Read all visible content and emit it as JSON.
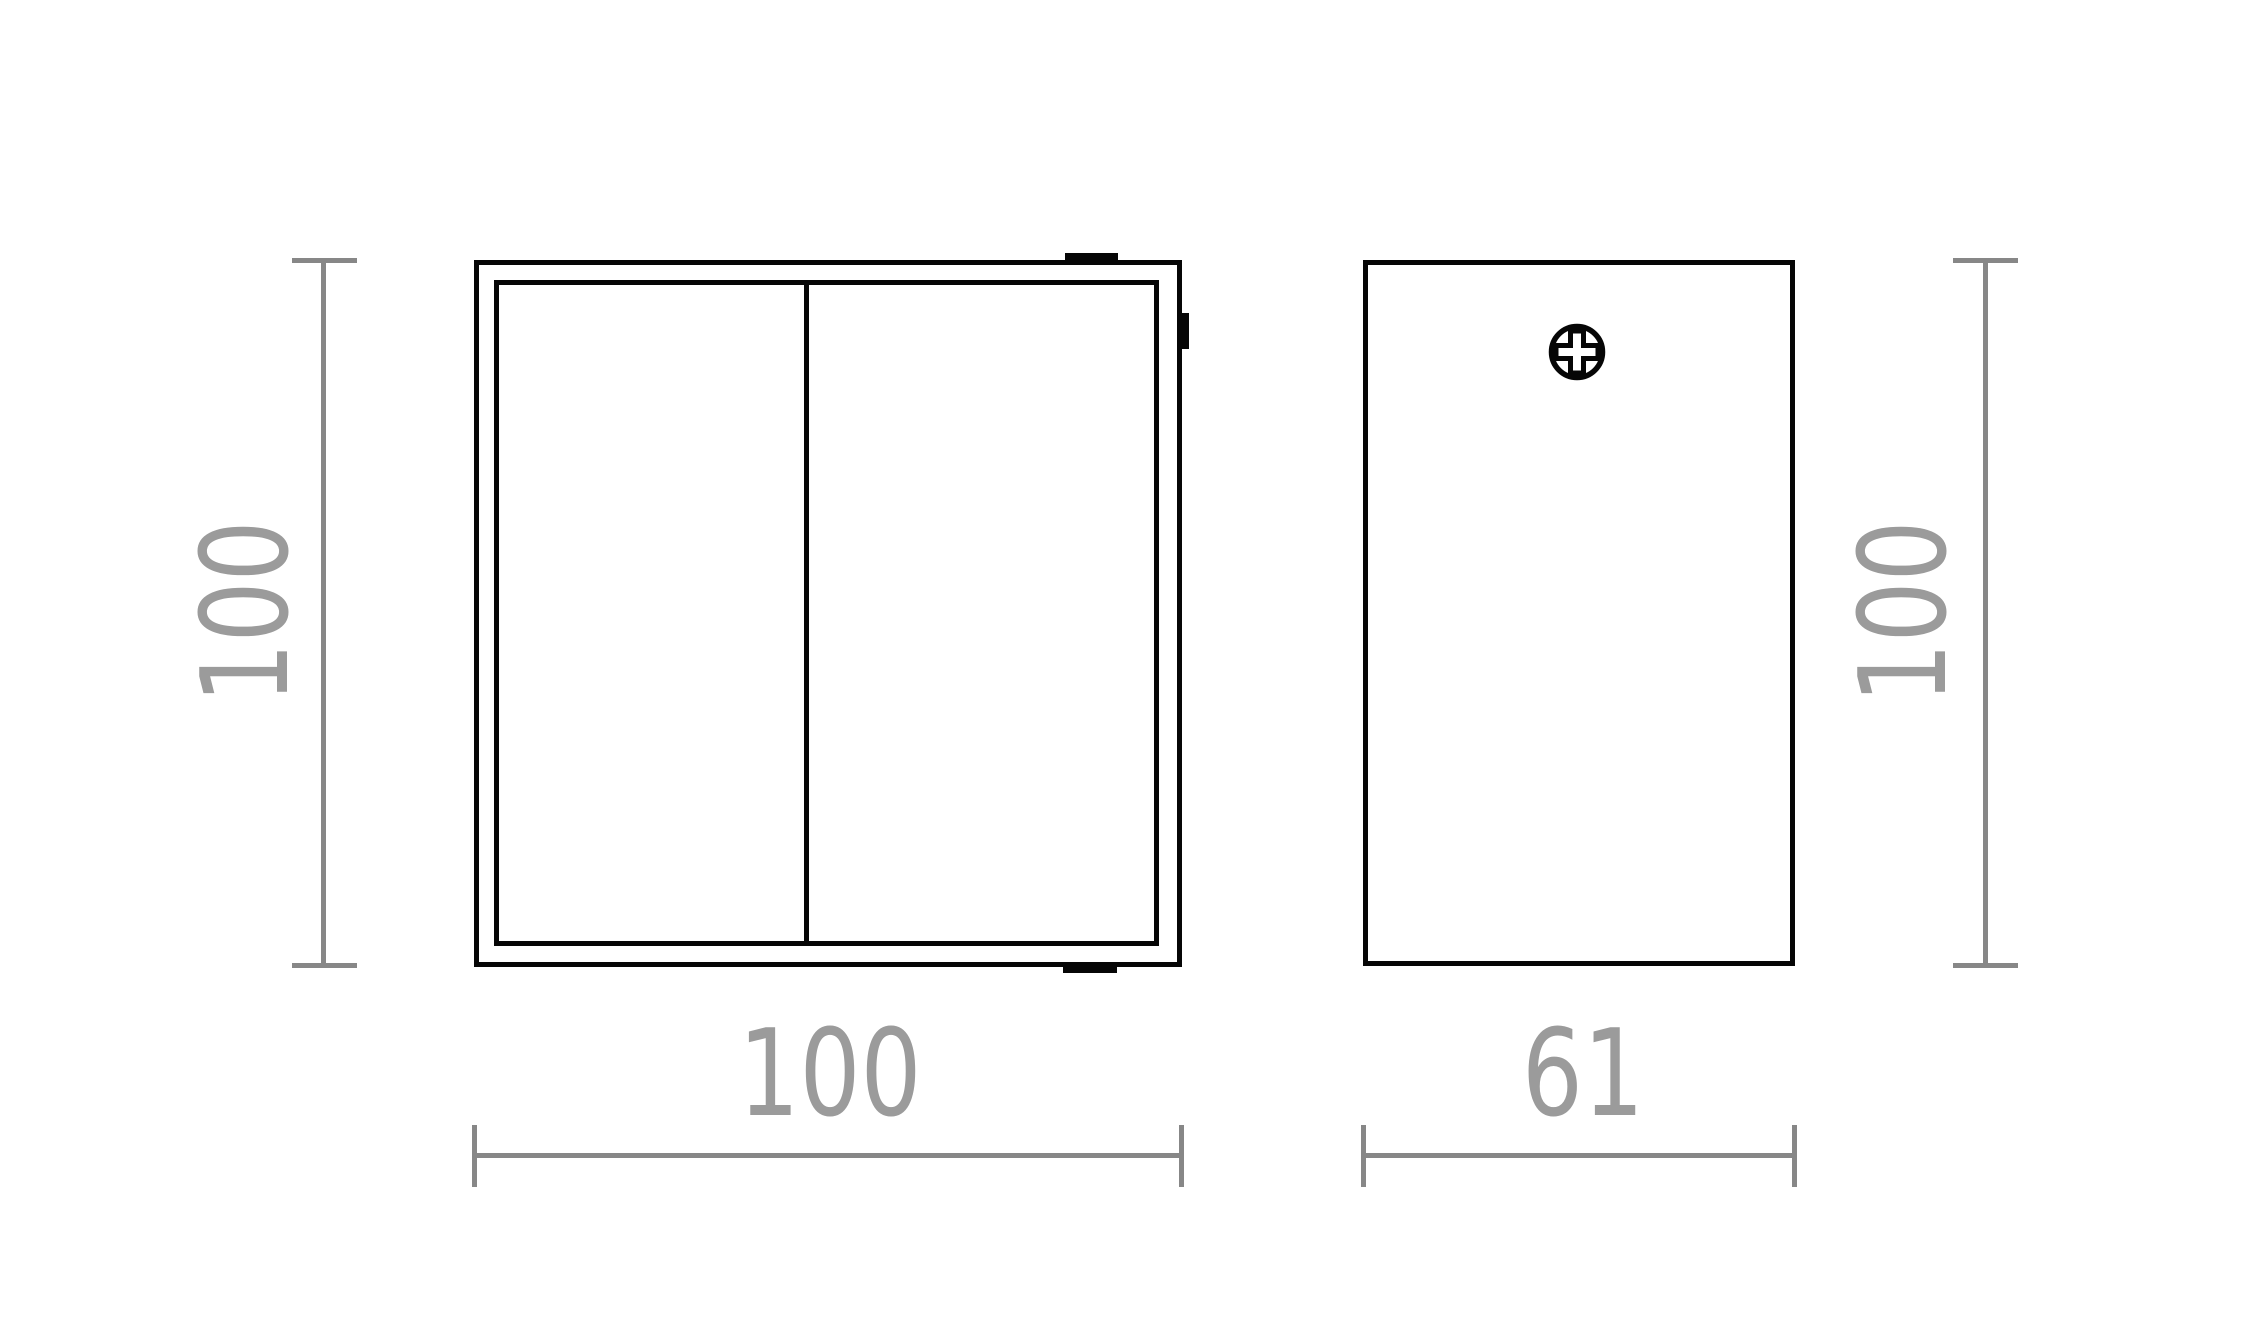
{
  "drawing": {
    "type": "technical-dimension-drawing",
    "colors": {
      "background": "#ffffff",
      "outline": "#060606",
      "dimension_line": "#878787",
      "dimension_text": "#9b9b9b"
    },
    "views": {
      "front": {
        "height_dimension": {
          "label": "100"
        },
        "width_dimension": {
          "label": "100"
        }
      },
      "side": {
        "width_dimension": {
          "label": "61"
        },
        "height_dimension": {
          "label": "100"
        }
      }
    },
    "icons": {
      "screw": "phillips-screw-head-icon"
    }
  }
}
